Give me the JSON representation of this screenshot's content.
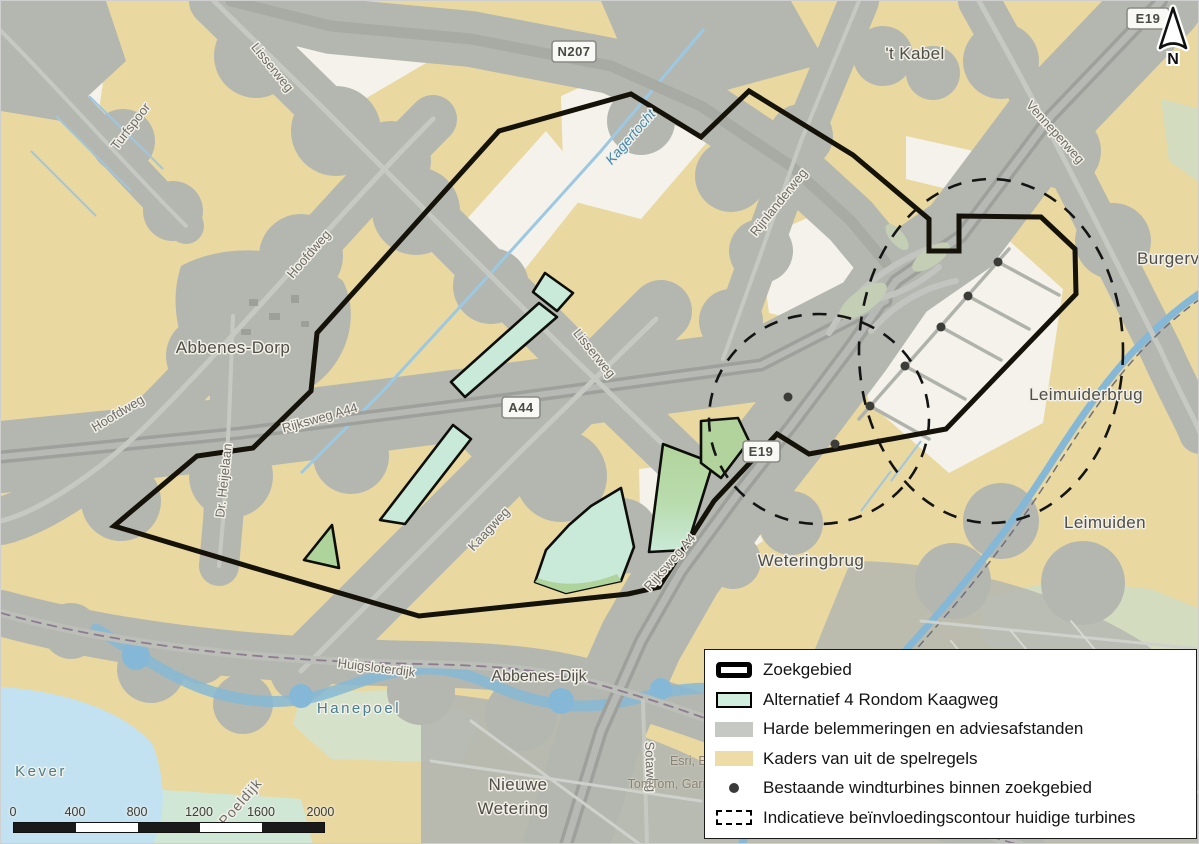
{
  "map": {
    "place_labels": {
      "t_kabel": "'t Kabel",
      "abbenes_dorp": "Abbenes-Dorp",
      "leimuiderbrug": "Leimuiderbrug",
      "leimuiden": "Leimuiden",
      "weteringbrug": "Weteringbrug",
      "nieuwe_wetering_line1": "Nieuwe",
      "nieuwe_wetering_line2": "Wetering",
      "burgerveen": "Burgerveen",
      "hanepoel": "Hanepoel",
      "kever": "Kever"
    },
    "road_labels": {
      "turfspoor": "Turfspoor",
      "lisserweg": "Lisserweg",
      "hoofdweg": "Hoofdweg",
      "rijksweg_a44": "Rijksweg A44",
      "rijksweg_a4": "Rijksweg A4",
      "kaagweg": "Kaagweg",
      "venneperweg": "Venneperweg",
      "rijnlanderweg": "Rijnlanderweg",
      "huigsloterdijk": "Huigsloterdijk",
      "abbenes_dijk": "Abbenes-Dijk",
      "sotaweg": "Sotaweg",
      "dr_heijelaan": "Dr. Heijelaan",
      "poeldijk": "Poeldijk"
    },
    "water_labels": {
      "kagertocht": "Kagertocht"
    },
    "road_shields": {
      "n207": "N207",
      "a44": "A44",
      "e19": "E19"
    },
    "turbines": {
      "color": "#3c3c38",
      "points": [
        [
          997,
          261
        ],
        [
          967,
          295
        ],
        [
          940,
          326
        ],
        [
          904,
          365
        ],
        [
          869,
          405
        ],
        [
          787,
          396
        ],
        [
          834,
          443
        ]
      ]
    },
    "colors": {
      "zoekgebied_line": "#15120a",
      "alternatief_fill": "#c9ead8",
      "alternatief_fill_dark": "#b2d49c",
      "harde_fill": "#b4b7b0",
      "kaders_fill": "#e9d8a0",
      "offwhite": "#f4f2ea",
      "water": "#8fbfdc"
    }
  },
  "legend": {
    "items": [
      {
        "key": "zoekgebied",
        "label": "Zoekgebied",
        "swatch": "outline-bold",
        "color": "#000000"
      },
      {
        "key": "alternatief",
        "label": "Alternatief 4 Rondom Kaagweg",
        "swatch": "fill-border",
        "color": "#cfeede"
      },
      {
        "key": "harde",
        "label": "Harde belemmeringen en adviesafstanden",
        "swatch": "fill",
        "color": "#c6c8c4"
      },
      {
        "key": "kaders",
        "label": "Kaders van uit de spelregels",
        "swatch": "fill",
        "color": "#eddca7"
      },
      {
        "key": "turbines",
        "label": "Bestaande windturbines binnen zoekgebied",
        "swatch": "dot",
        "color": "#3a3a3a"
      },
      {
        "key": "contour",
        "label": "Indicatieve beïnvloedingscontour huidige turbines",
        "swatch": "dashed",
        "color": "#000000"
      }
    ]
  },
  "scale_bar": {
    "labels": [
      "0",
      "400",
      "800",
      "1200",
      "1600",
      "2000 m"
    ]
  },
  "north": {
    "label": "N"
  },
  "attribution": {
    "line1": "Esri, Es",
    "line2": "TomTom, Garm"
  }
}
